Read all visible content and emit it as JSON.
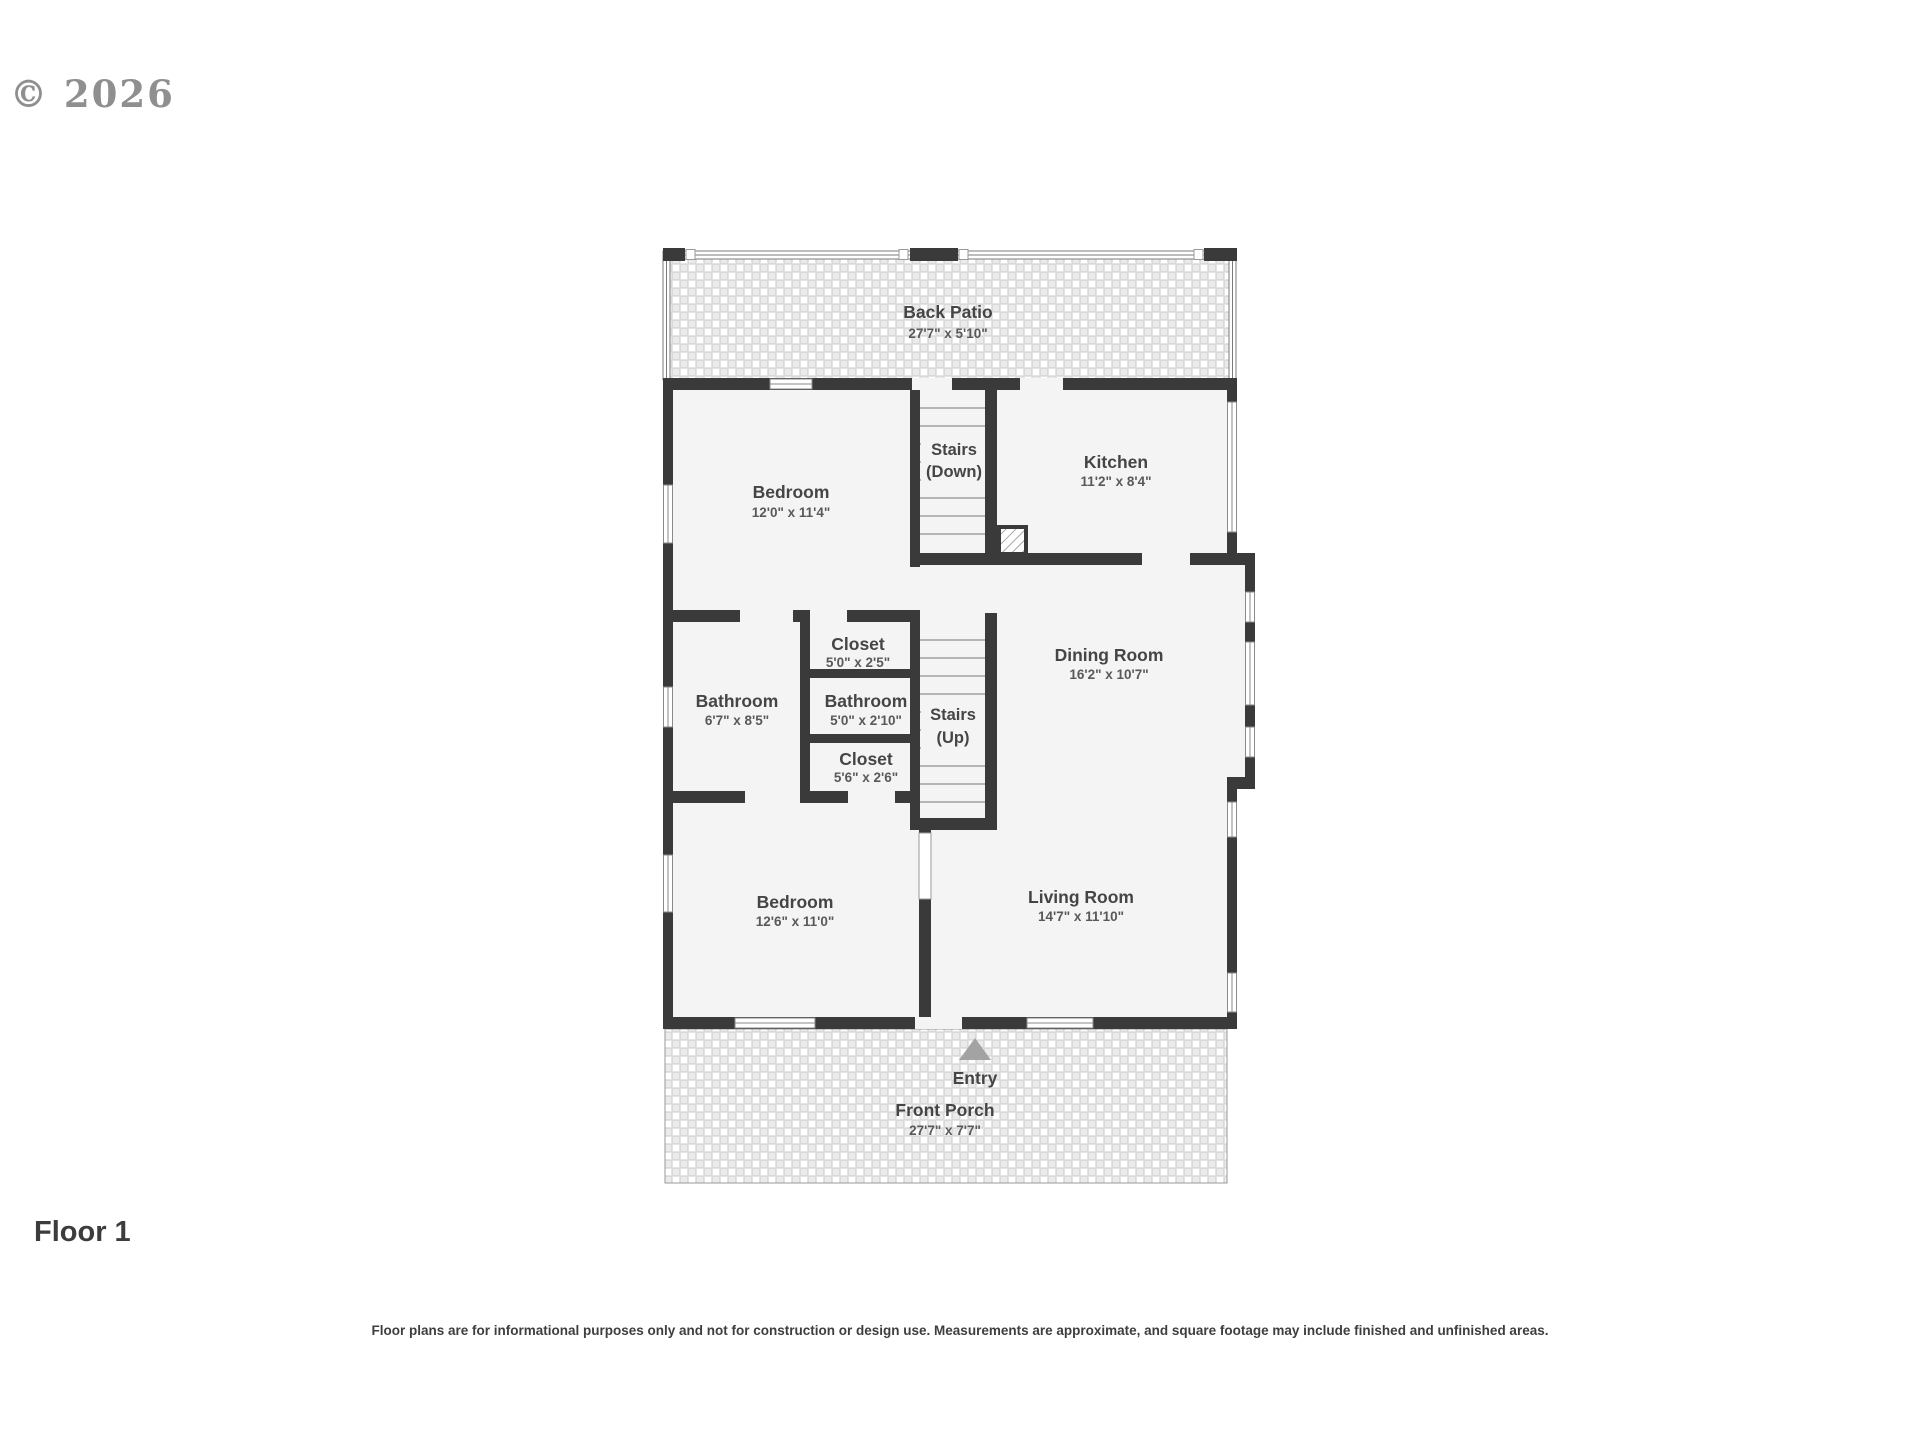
{
  "watermark": "© 2026",
  "floor": {
    "label": "Floor 1"
  },
  "disclaimer": "Floor plans are for informational purposes only and not for construction or design use. Measurements are approximate, and square footage may include finished and unfinished areas.",
  "colors": {
    "wall": "#3a3a3a",
    "floor": "#f4f4f4",
    "room_name": "#454545",
    "room_dims": "#595959"
  },
  "rooms": {
    "back_patio": {
      "name": "Back Patio",
      "dims": "27'7\" x 5'10\""
    },
    "bedroom_top": {
      "name": "Bedroom",
      "dims": "12'0\" x 11'4\""
    },
    "stairs_down": {
      "line1": "Stairs",
      "line2": "(Down)"
    },
    "kitchen": {
      "name": "Kitchen",
      "dims": "11'2\" x 8'4\""
    },
    "closet_upper": {
      "name": "Closet",
      "dims": "5'0\" x 2'5\""
    },
    "bathroom_main": {
      "name": "Bathroom",
      "dims": "6'7\" x 8'5\""
    },
    "bathroom_small": {
      "name": "Bathroom",
      "dims": "5'0\" x 2'10\""
    },
    "stairs_up": {
      "line1": "Stairs",
      "line2": "(Up)"
    },
    "dining_room": {
      "name": "Dining Room",
      "dims": "16'2\" x 10'7\""
    },
    "closet_lower": {
      "name": "Closet",
      "dims": "5'6\" x 2'6\""
    },
    "bedroom_bottom": {
      "name": "Bedroom",
      "dims": "12'6\" x 11'0\""
    },
    "living_room": {
      "name": "Living Room",
      "dims": "14'7\" x 11'10\""
    },
    "entry": {
      "name": "Entry"
    },
    "front_porch": {
      "name": "Front Porch",
      "dims": "27'7\" x 7'7\""
    }
  }
}
